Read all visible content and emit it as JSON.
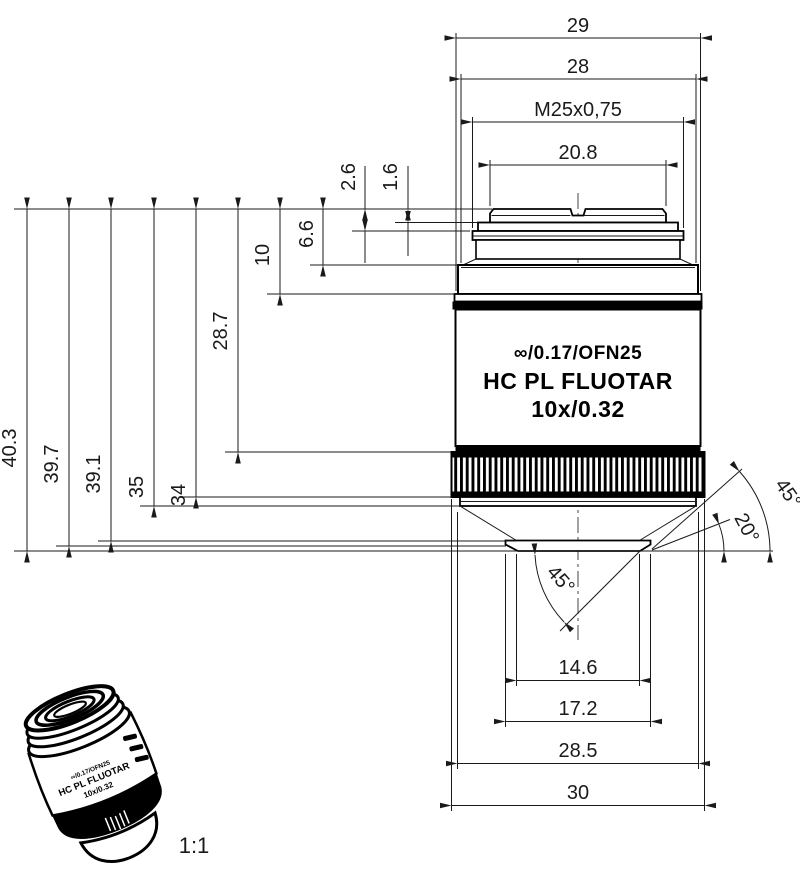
{
  "dimensions": {
    "top": {
      "d29": "29",
      "d28": "28",
      "thread": "M25x0,75",
      "d20_8": "20.8"
    },
    "left": {
      "l40_3": "40.3",
      "l39_7": "39.7",
      "l39_1": "39.1",
      "l35": "35",
      "l34": "34",
      "l28_7": "28.7",
      "l10": "10",
      "l6_6": "6.6",
      "l2_6": "2.6",
      "l1_6": "1.6"
    },
    "bottom": {
      "d14_6": "14.6",
      "d17_2": "17.2",
      "d28_5": "28.5",
      "d30": "30"
    },
    "angles": {
      "upper_right": "45°",
      "lower_right": "20°",
      "bottom": "45°"
    }
  },
  "engraving": {
    "line1": "∞/0.17/OFN25",
    "line2": "HC PL FLUOTAR",
    "line3": "10x/0.32"
  },
  "thumbnail": {
    "scale": "1:1",
    "engraving_line1": "∞/0.17/OFN25",
    "engraving_line2": "HC PL FLUOTAR",
    "engraving_line3": "10x/0.32"
  }
}
